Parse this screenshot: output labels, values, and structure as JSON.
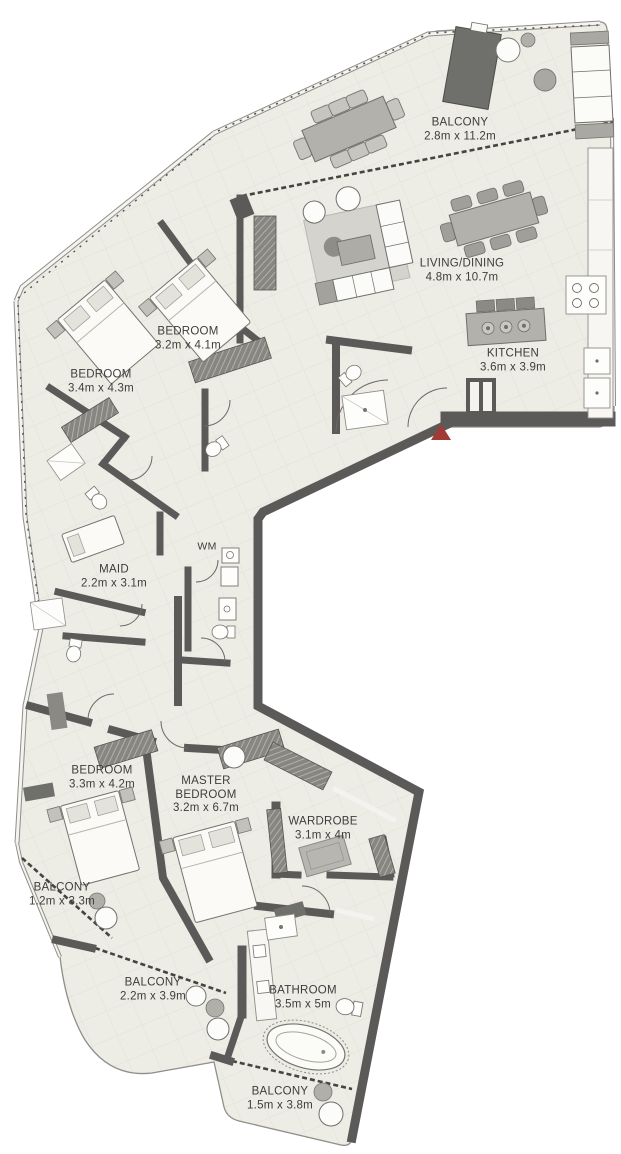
{
  "plan_title": "3 Bedroom + Maid Apartment Floor Plan",
  "colors": {
    "wall": "#5b5a58",
    "floor": "#edece5",
    "outline": "#8f8e89",
    "glass_dash": "#45443f",
    "furniture_gray": "#b2b1ab",
    "furniture_dark": "#6f6f6c",
    "entry_marker_red": "#a23a36",
    "label_text": "#3e3d3b"
  },
  "icons": {
    "entry_marker": "entry-arrow-icon",
    "bed": "bed-icon",
    "bathtub": "bathtub-icon",
    "toilet": "toilet-icon",
    "kitchen_island": "kitchen-island-icon",
    "sofa": "sofa-icon",
    "dining_table": "dining-table-icon",
    "washing_machine": "washing-machine-icon"
  },
  "rooms": [
    {
      "id": "balcony-top",
      "name": "BALCONY",
      "dims": "2.8m x 11.2m"
    },
    {
      "id": "living-dining",
      "name": "LIVING/DINING",
      "dims": "4.8m x 10.7m"
    },
    {
      "id": "kitchen",
      "name": "KITCHEN",
      "dims": "3.6m x 3.9m"
    },
    {
      "id": "bedroom-2",
      "name": "BEDROOM",
      "dims": "3.2m x 4.1m"
    },
    {
      "id": "bedroom-1",
      "name": "BEDROOM",
      "dims": "3.4m x 4.3m"
    },
    {
      "id": "maid",
      "name": "MAID",
      "dims": "2.2m x 3.1m"
    },
    {
      "id": "wm",
      "name": "WM",
      "dims": ""
    },
    {
      "id": "bedroom-3",
      "name": "BEDROOM",
      "dims": "3.3m x 4.2m"
    },
    {
      "id": "master-bedroom",
      "name": "MASTER BEDROOM",
      "dims": "3.2m x 6.7m"
    },
    {
      "id": "wardrobe",
      "name": "WARDROBE",
      "dims": "3.1m x 4m"
    },
    {
      "id": "balcony-left",
      "name": "BALCONY",
      "dims": "1.2m x 3.3m"
    },
    {
      "id": "balcony-middle",
      "name": "BALCONY",
      "dims": "2.2m x 3.9m"
    },
    {
      "id": "bathroom",
      "name": "BATHROOM",
      "dims": "3.5m x 5m"
    },
    {
      "id": "balcony-bottom",
      "name": "BALCONY",
      "dims": "1.5m x 3.8m"
    }
  ]
}
